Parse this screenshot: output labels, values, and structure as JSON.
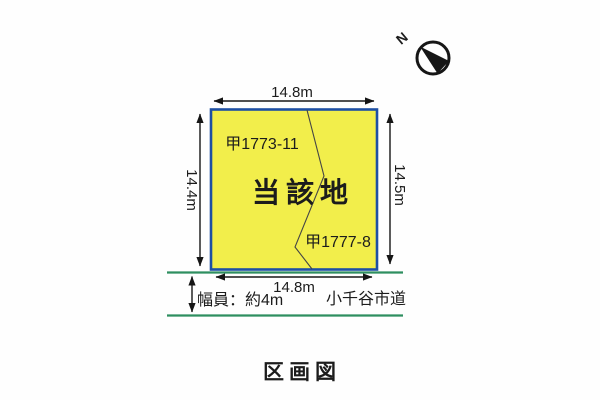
{
  "page": {
    "title": "区画図",
    "background": "#fefefe"
  },
  "compass": {
    "label": "N"
  },
  "site": {
    "label": "当該地",
    "parcel_upper": "甲1773-11",
    "parcel_lower": "甲1777-8",
    "fill": "#f2ee4b",
    "border": "#1e4fa3"
  },
  "dimensions": {
    "top": "14.8m",
    "bottom": "14.8m",
    "left": "14.4m",
    "right": "14.5m"
  },
  "road": {
    "name": "小千谷市道",
    "width_label": "幅員：約4m",
    "color": "#2e8f60"
  }
}
